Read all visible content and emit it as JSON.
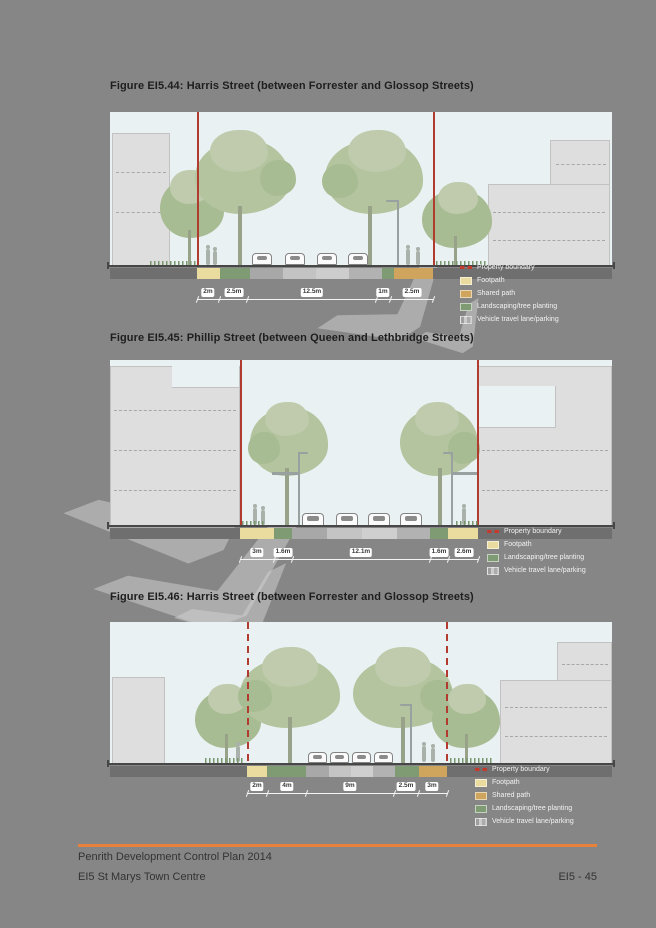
{
  "page": {
    "background_color": "#868686",
    "palette": {
      "sky": "#e9f1f3",
      "building": "#dedede",
      "tree_canopy": "#b3c49e",
      "footpath": "#eadc9e",
      "shared_path": "#cfa45c",
      "landscaping": "#7f9b74",
      "road": "#b5b5b5",
      "property_boundary": "#b23b30",
      "ground_strip": "#6f6f6f",
      "footer_rule": "#e8813b"
    }
  },
  "figures": [
    {
      "title": "Figure EI5.44: Harris Street (between Forrester and Glossop Streets)",
      "dimensions": [
        "2m",
        "2.5m",
        "12.5m",
        "1m",
        "2.5m"
      ],
      "legend": [
        {
          "label": "Property boundary",
          "color": "#b23b30",
          "style": "red-dashed-line"
        },
        {
          "label": "Footpath",
          "color": "#eadc9e"
        },
        {
          "label": "Shared path",
          "color": "#cfa45c"
        },
        {
          "label": "Landscaping/tree planting",
          "color": "#7f9b74"
        },
        {
          "label": "Vehicle travel lane/parking",
          "color": "#b5b5b5"
        }
      ]
    },
    {
      "title": "Figure EI5.45: Phillip Street (between Queen and Lethbridge Streets)",
      "dimensions": [
        "3m",
        "1.6m",
        "12.1m",
        "1.6m",
        "2.6m"
      ],
      "legend": [
        {
          "label": "Property boundary",
          "color": "#b23b30",
          "style": "red-dashed-line"
        },
        {
          "label": "Footpath",
          "color": "#eadc9e"
        },
        {
          "label": "Landscaping/tree planting",
          "color": "#7f9b74"
        },
        {
          "label": "Vehicle travel lane/parking",
          "color": "#b5b5b5"
        }
      ]
    },
    {
      "title": "Figure EI5.46: Harris Street (between Forrester and Glossop Streets)",
      "dimensions": [
        "2m",
        "4m",
        "9m",
        "2.5m",
        "3m"
      ],
      "legend": [
        {
          "label": "Property boundary",
          "color": "#b23b30",
          "style": "red-dashed-line"
        },
        {
          "label": "Footpath",
          "color": "#eadc9e"
        },
        {
          "label": "Shared path",
          "color": "#cfa45c"
        },
        {
          "label": "Landscaping/tree planting",
          "color": "#7f9b74"
        },
        {
          "label": "Vehicle travel lane/parking",
          "color": "#b5b5b5"
        }
      ]
    }
  ],
  "footer": {
    "line1": "Penrith Development Control Plan 2014",
    "line2": "EI5 St Marys Town Centre",
    "page_number": "EI5 - 45"
  }
}
